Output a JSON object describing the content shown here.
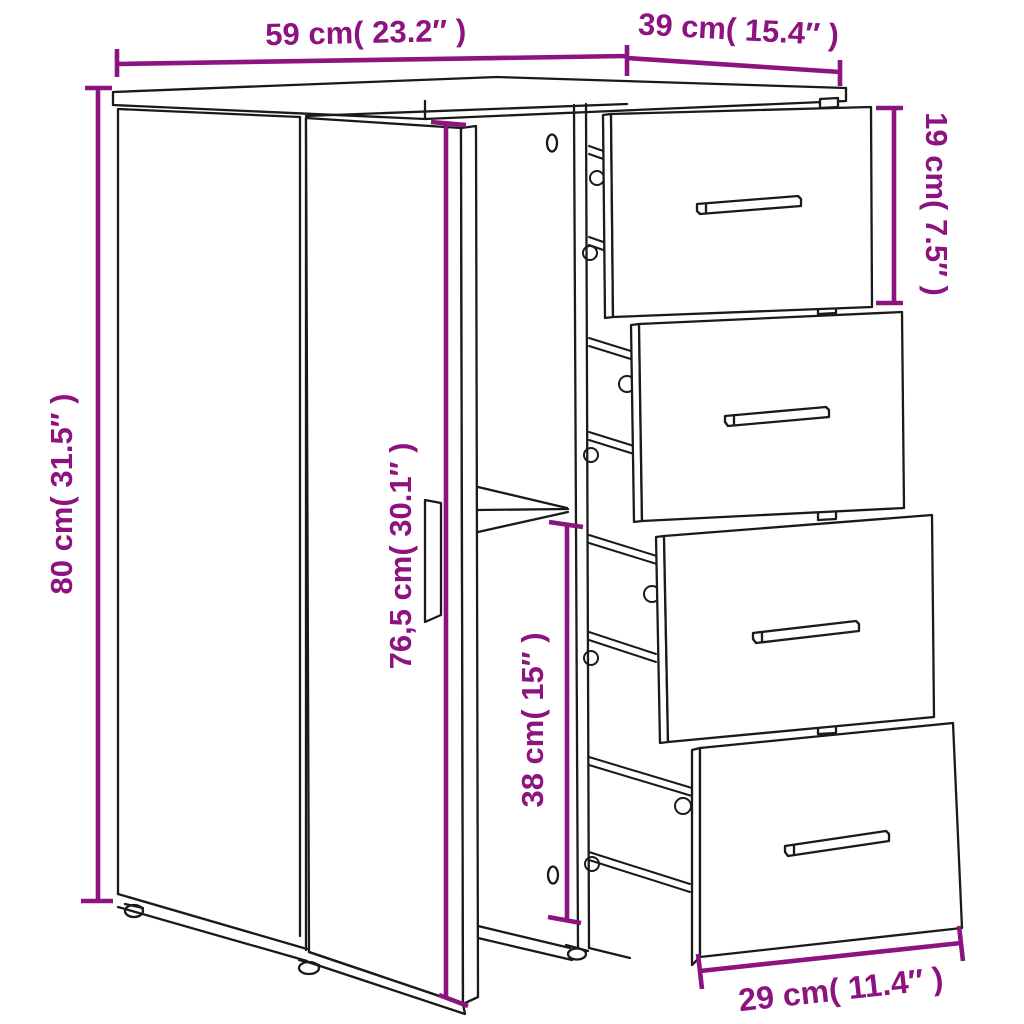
{
  "diagram": {
    "type": "furniture-dimension-diagram",
    "subject": "sideboard with open door and four pulled-out drawers",
    "style": {
      "background": "#ffffff",
      "line_color": "#1a1a1a",
      "dimension_color": "#8c1380"
    },
    "dimensions": {
      "width": "59 cm( 23.2″ )",
      "depth": "39 cm( 15.4″ )",
      "height": "80 cm( 31.5″ )",
      "top_drawer_height": "19 cm( 7.5″ )",
      "door_height": "76,5 cm( 30.1″ )",
      "lower_compartment_height": "38 cm( 15″ )",
      "drawer_front_width": "29 cm( 11.4″ )"
    }
  }
}
